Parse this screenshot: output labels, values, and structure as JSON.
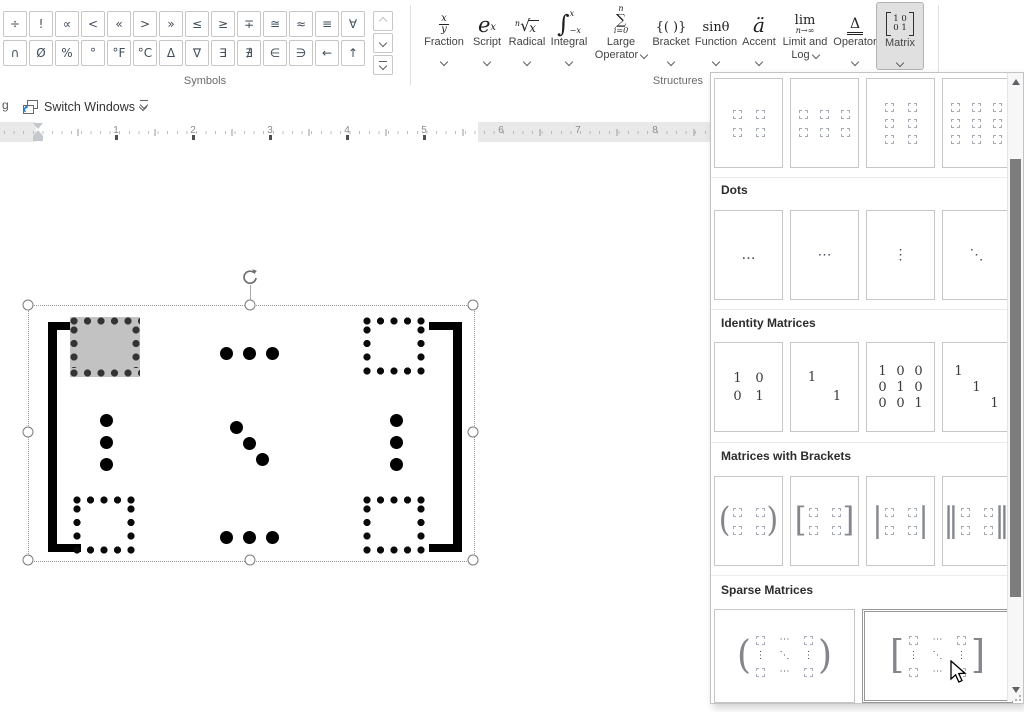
{
  "ribbon": {
    "symbols_label": "Symbols",
    "structures_label": "Structures",
    "symbols": [
      "÷",
      "!",
      "∝",
      "<",
      "«",
      ">",
      "»",
      "≤",
      "≥",
      "∓",
      "≅",
      "≈",
      "≡",
      "∀",
      "∩",
      "Ø",
      "%",
      "°",
      "°F",
      "°C",
      "Δ",
      "∇",
      "∃",
      "∄",
      "∈",
      "∋",
      "←",
      "↑"
    ],
    "structures": [
      {
        "label1": "Fraction",
        "icon_num": "x",
        "icon_den": "y"
      },
      {
        "label1": "Script",
        "icon_base": "e",
        "icon_sup": "x"
      },
      {
        "label1": "Radical",
        "icon_pre": "n",
        "icon_rad": "√",
        "icon_base": "x"
      },
      {
        "label1": "Integral",
        "icon_sym": "∫",
        "icon_sup": "x",
        "icon_sub": "−x"
      },
      {
        "label1": "Large",
        "label2": "Operator",
        "icon_sup": "n",
        "icon_sym": "∑",
        "icon_sub": "i=0"
      },
      {
        "label1": "Bracket",
        "icon_sym": "{( )}"
      },
      {
        "label1": "Function",
        "icon_sym": "sinθ"
      },
      {
        "label1": "Accent",
        "icon_sym": "ä"
      },
      {
        "label1": "Limit and",
        "label2": "Log",
        "icon_sym": "lim",
        "icon_sub": "n→∞"
      },
      {
        "label1": "Operator",
        "icon_sym": "Δ"
      },
      {
        "label1": "Matrix",
        "icon_r1": "1 0",
        "icon_r2": "0 1",
        "active": true
      }
    ]
  },
  "toolbar": {
    "partial_label": "g",
    "switch_windows_label": "Switch Windows"
  },
  "ruler": {
    "numbers": [
      "1",
      "2",
      "3",
      "4",
      "5",
      "6",
      "7",
      "8"
    ]
  },
  "panel": {
    "dots_header": "Dots",
    "identity_header": "Identity Matrices",
    "brackets_header": "Matrices with Brackets",
    "sparse_header": "Sparse Matrices",
    "dot_glyphs": {
      "low": "…",
      "mid": "⋯",
      "vert": "⋮",
      "diag": "⋱"
    },
    "identity_cards": [
      {
        "rows": [
          [
            "1",
            "0"
          ],
          [
            "0",
            "1"
          ]
        ]
      },
      {
        "rows": [
          [
            "1",
            ""
          ],
          [
            "",
            "1"
          ]
        ]
      },
      {
        "rows": [
          [
            "1",
            "0",
            "0"
          ],
          [
            "0",
            "1",
            "0"
          ],
          [
            "0",
            "0",
            "1"
          ]
        ]
      },
      {
        "rows": [
          [
            "1",
            "",
            ""
          ],
          [
            "",
            "1",
            ""
          ],
          [
            "",
            "",
            "1"
          ]
        ]
      }
    ],
    "bracket_cards": [
      {
        "open": "(",
        "close": ")"
      },
      {
        "open": "[",
        "close": "]"
      },
      {
        "open": "|",
        "close": "|"
      },
      {
        "open": "‖",
        "close": "‖"
      }
    ],
    "sparse_cards": [
      {
        "open": "(",
        "close": ")"
      },
      {
        "open": "[",
        "close": "]"
      }
    ]
  }
}
